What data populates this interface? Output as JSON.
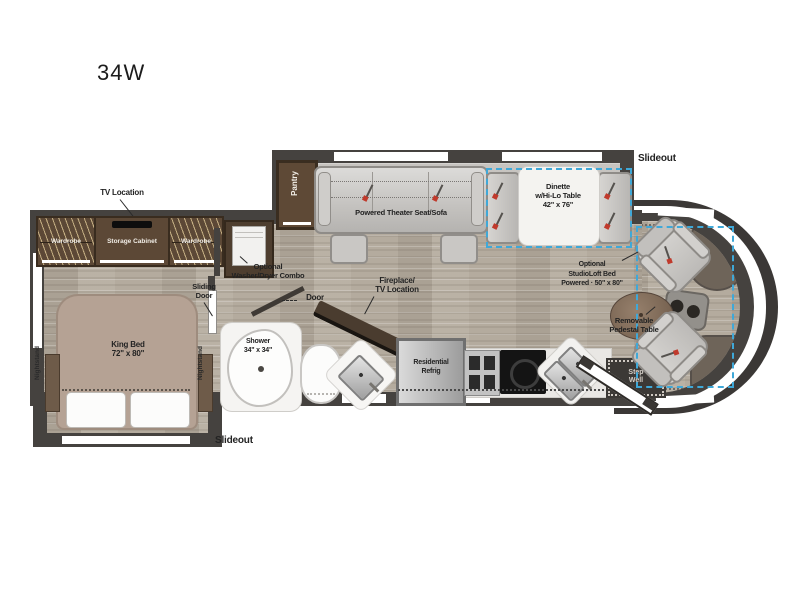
{
  "title": "34W",
  "colors": {
    "wall": "#45423f",
    "floor_wood": "#b4ab9e",
    "slideout_floor": "#c7c4c0",
    "cabinet_brown": "#5c4836",
    "bed_taupe": "#b5a294",
    "fixture_white": "#f5f4f2",
    "optional_dashed_outline": "#3fa8d8",
    "seatbelt_red": "#c03a2c",
    "label_text": "#232323"
  },
  "labels": {
    "slideout_top": "Slideout",
    "slideout_bottom": "Slideout",
    "tv_location": "TV Location",
    "wardrobe_left": "Wardrobe",
    "wardrobe_right": "Wardrobe",
    "storage_cabinet": "Storage Cabinet",
    "pantry": "Pantry",
    "theater_sofa": "Powered Theater Seat/Sofa",
    "dinette": [
      "Dinette",
      "w/Hi-Lo Table",
      "42\" x 76\""
    ],
    "washer": [
      "Optional",
      "Washer/Dryer Combo"
    ],
    "sliding_door": [
      "Sliding",
      "Door"
    ],
    "door": "Door",
    "nightstand_left": "Nightstand",
    "nightstand_right": "Nightstand",
    "king_bed": [
      "King Bed",
      "72\" x 80\""
    ],
    "shower": [
      "Shower",
      "34\" x 34\""
    ],
    "fireplace": [
      "Fireplace/",
      "TV Location"
    ],
    "refrigerator": [
      "Residential",
      "Refrig"
    ],
    "studioloft": [
      "Optional",
      "StudioLoft Bed",
      "Powered · 50\" x 80\""
    ],
    "pedestal_table": [
      "Removable",
      "Pedestal Table"
    ],
    "step_well": [
      "Step",
      "Well"
    ]
  }
}
